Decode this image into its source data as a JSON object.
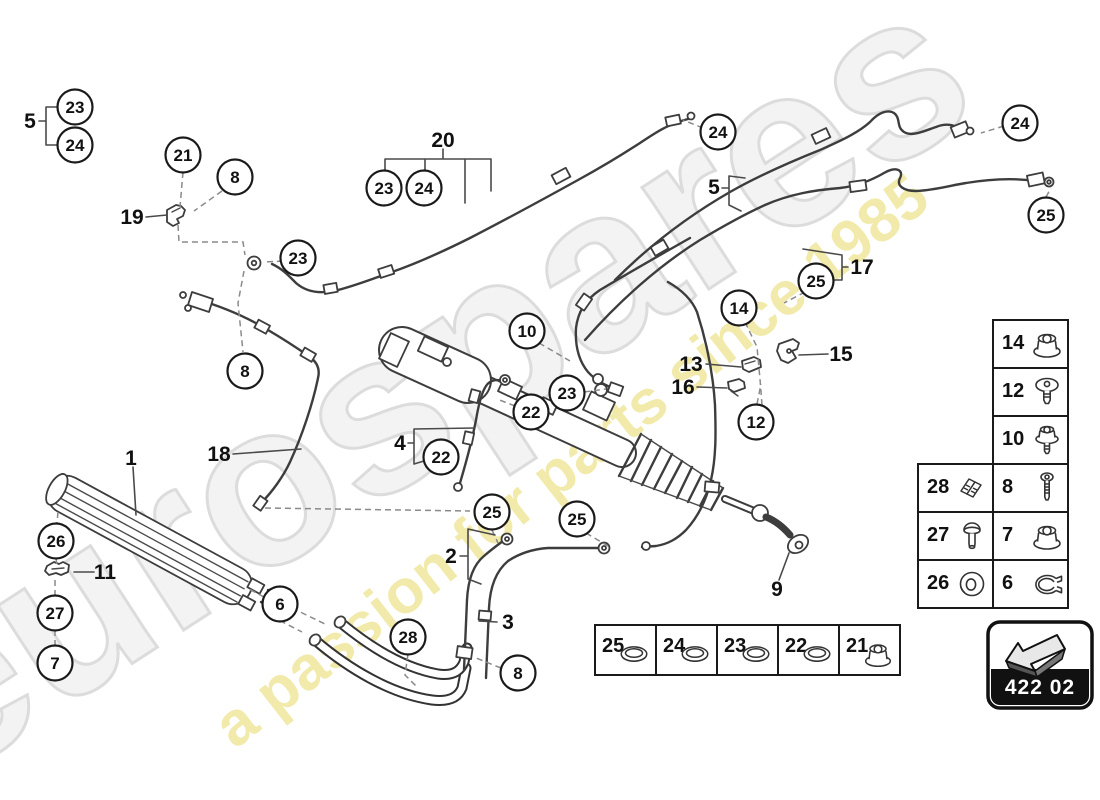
{
  "watermark": {
    "brand": "eurospares",
    "brand_color": "#f3f3f3",
    "brand_stroke": "#dcdcdc",
    "tagline": "a passion for parts since 1985",
    "tagline_color": "#f1e8a2"
  },
  "badge": {
    "code": "422 02"
  },
  "diagram": {
    "callouts": [
      {
        "n": "23",
        "x": 75,
        "y": 107
      },
      {
        "n": "24",
        "x": 75,
        "y": 145
      },
      {
        "n": "21",
        "x": 183,
        "y": 155
      },
      {
        "n": "8",
        "x": 235,
        "y": 177
      },
      {
        "n": "23",
        "x": 298,
        "y": 258
      },
      {
        "n": "23",
        "x": 384,
        "y": 188
      },
      {
        "n": "24",
        "x": 424,
        "y": 188
      },
      {
        "n": "24",
        "x": 718,
        "y": 132
      },
      {
        "n": "24",
        "x": 1020,
        "y": 123
      },
      {
        "n": "25",
        "x": 1046,
        "y": 215
      },
      {
        "n": "25",
        "x": 816,
        "y": 281
      },
      {
        "n": "14",
        "x": 739,
        "y": 308
      },
      {
        "n": "10",
        "x": 527,
        "y": 331
      },
      {
        "n": "23",
        "x": 567,
        "y": 393
      },
      {
        "n": "22",
        "x": 531,
        "y": 412
      },
      {
        "n": "22",
        "x": 441,
        "y": 457
      },
      {
        "n": "12",
        "x": 756,
        "y": 422
      },
      {
        "n": "8",
        "x": 245,
        "y": 371
      },
      {
        "n": "26",
        "x": 56,
        "y": 541
      },
      {
        "n": "27",
        "x": 55,
        "y": 613
      },
      {
        "n": "7",
        "x": 55,
        "y": 663
      },
      {
        "n": "6",
        "x": 280,
        "y": 604
      },
      {
        "n": "28",
        "x": 408,
        "y": 637
      },
      {
        "n": "25",
        "x": 492,
        "y": 512
      },
      {
        "n": "25",
        "x": 577,
        "y": 519
      },
      {
        "n": "8",
        "x": 518,
        "y": 673
      }
    ],
    "labels": [
      {
        "t": "5",
        "x": 30,
        "y": 121
      },
      {
        "t": "19",
        "x": 132,
        "y": 217
      },
      {
        "t": "20",
        "x": 443,
        "y": 140
      },
      {
        "t": "5",
        "x": 714,
        "y": 187
      },
      {
        "t": "17",
        "x": 862,
        "y": 267
      },
      {
        "t": "15",
        "x": 841,
        "y": 354
      },
      {
        "t": "13",
        "x": 691,
        "y": 364
      },
      {
        "t": "16",
        "x": 683,
        "y": 387
      },
      {
        "t": "1",
        "x": 131,
        "y": 458
      },
      {
        "t": "18",
        "x": 219,
        "y": 454
      },
      {
        "t": "4",
        "x": 400,
        "y": 443
      },
      {
        "t": "11",
        "x": 105,
        "y": 572
      },
      {
        "t": "2",
        "x": 451,
        "y": 556
      },
      {
        "t": "3",
        "x": 508,
        "y": 622
      },
      {
        "t": "9",
        "x": 777,
        "y": 589
      }
    ],
    "legend": {
      "rows": [
        {
          "cells": [
            {
              "num": "14",
              "icon": "flange-nut"
            }
          ]
        },
        {
          "cells": [
            {
              "num": "12",
              "icon": "screw"
            }
          ]
        },
        {
          "cells": [
            {
              "num": "10",
              "icon": "stud-nut"
            }
          ]
        },
        {
          "cells": [
            {
              "num": "28",
              "icon": "clip"
            },
            {
              "num": "8",
              "icon": "bolt"
            }
          ]
        },
        {
          "cells": [
            {
              "num": "27",
              "icon": "rivet"
            },
            {
              "num": "7",
              "icon": "flange-nut"
            }
          ]
        },
        {
          "cells": [
            {
              "num": "26",
              "icon": "washer"
            },
            {
              "num": "6",
              "icon": "clamp"
            }
          ]
        }
      ]
    },
    "seals": {
      "cells": [
        {
          "num": "25",
          "icon": "o-ring"
        },
        {
          "num": "24",
          "icon": "o-ring"
        },
        {
          "num": "23",
          "icon": "o-ring"
        },
        {
          "num": "22",
          "icon": "o-ring"
        },
        {
          "num": "21",
          "icon": "flange-nut"
        }
      ]
    }
  }
}
